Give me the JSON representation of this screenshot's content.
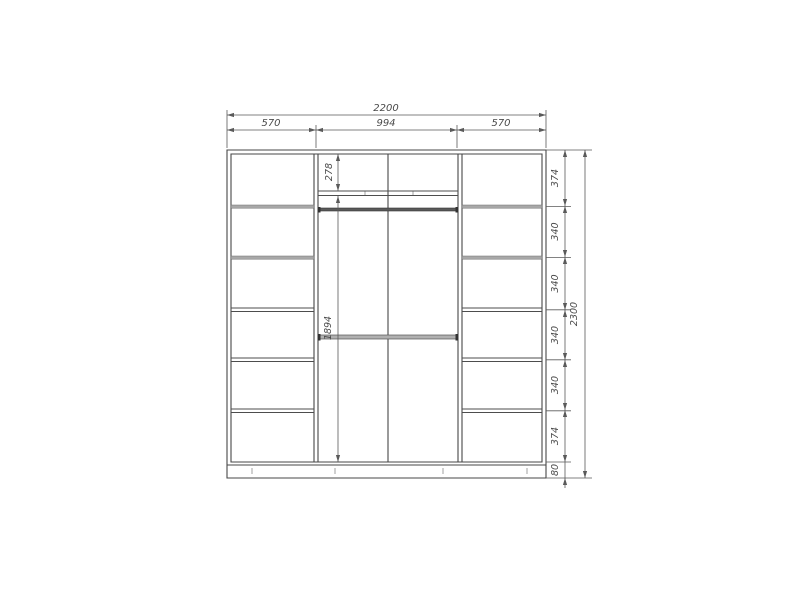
{
  "colors": {
    "background": "#ffffff",
    "structure_line": "#474747",
    "dimension_line": "#5a5a5a",
    "shelf_fill": "#a8a8a8",
    "rod_fill": "#b0b0b0"
  },
  "dimensions": {
    "overall_width": "2200",
    "section_widths": [
      "570",
      "994",
      "570"
    ],
    "overall_height": "2300",
    "height_segments": [
      "374",
      "340",
      "340",
      "340",
      "340",
      "374",
      "80"
    ],
    "top_shelf_height": "278",
    "hanging_section_height": "1894"
  }
}
